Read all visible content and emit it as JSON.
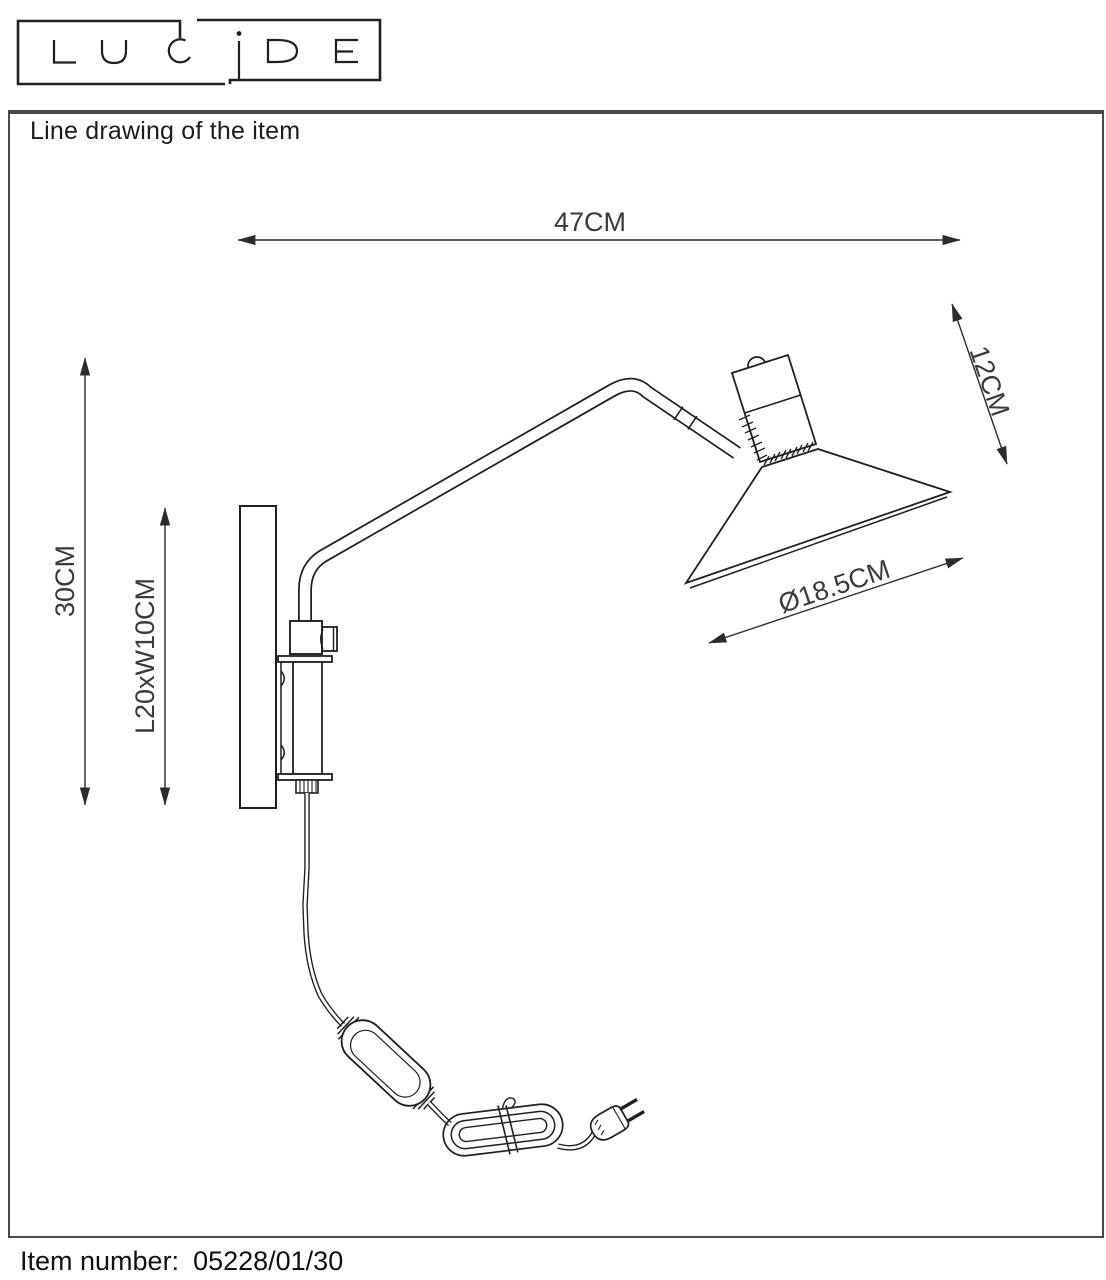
{
  "logo": {
    "brand": "LUCIDE"
  },
  "header": {
    "title": "Line drawing of the item"
  },
  "dimensions": {
    "arm_reach": "47CM",
    "head_height": "12CM",
    "total_height": "30CM",
    "backplate": "L20xW10CM",
    "shade_diameter": "Ø18.5CM"
  },
  "footer": {
    "label": "Item number:",
    "value": "05228/01/30"
  }
}
